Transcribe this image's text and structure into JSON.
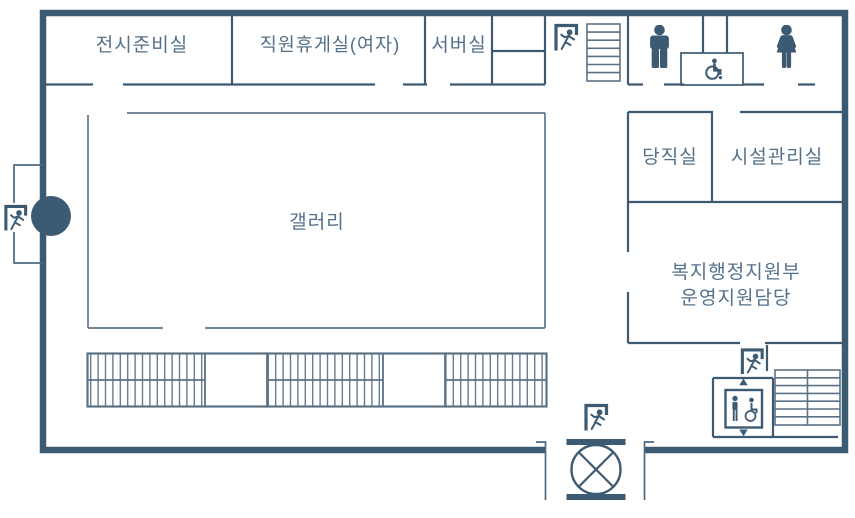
{
  "colors": {
    "wall": "#3d5a73",
    "thin_wall": "#60768a",
    "hatch": "#5b7186",
    "icon": "#3d5a73",
    "text": "#54708a",
    "background": "#ffffff"
  },
  "floorplan": {
    "rooms": [
      {
        "name": "exhibition-prep-room",
        "label": "전시준비실"
      },
      {
        "name": "staff-lounge-women",
        "label": "직원휴게실(여자)"
      },
      {
        "name": "server-room",
        "label": "서버실"
      },
      {
        "name": "gallery",
        "label": "갤러리"
      },
      {
        "name": "duty-room",
        "label": "당직실"
      },
      {
        "name": "facility-management-room",
        "label": "시설관리실"
      },
      {
        "name": "welfare-admin-support",
        "line1": "복지행정지원부",
        "line2": "운영지원담당"
      }
    ],
    "icons": [
      "emergency-exit-icon",
      "stairs-icon",
      "mens-restroom-icon",
      "womens-restroom-icon",
      "wheelchair-accessible-icon",
      "elevator-icon",
      "accessible-elevator-icon"
    ]
  }
}
